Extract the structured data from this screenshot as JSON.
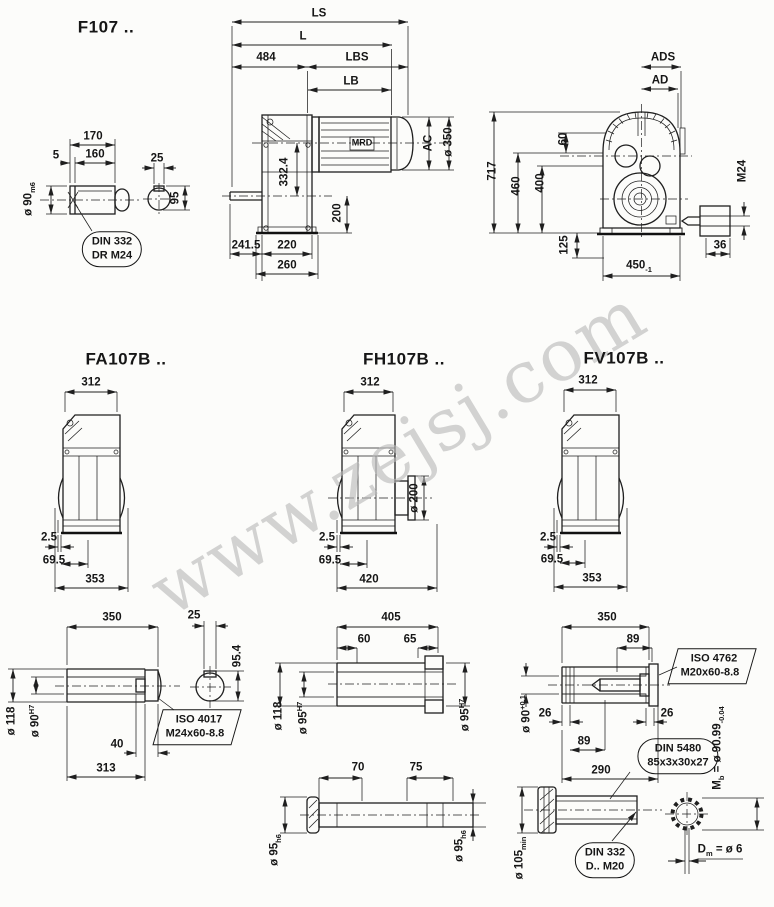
{
  "watermark": "www.zejsj.com",
  "f107": {
    "title": "F107 ..",
    "input_shaft": {
      "d170": "170",
      "d5": "5",
      "d160": "160",
      "dia90": "ø 90",
      "dia90_tol": "m6",
      "d25": "25",
      "d95": "95",
      "callout": {
        "line1": "DIN 332",
        "line2": "DR M24"
      }
    },
    "side": {
      "ls": "LS",
      "l": "L",
      "d484": "484",
      "lbs": "LBS",
      "lb": "LB",
      "motor": "MRD",
      "ac": "AC",
      "dia350": "ø 350",
      "d332": "332.4",
      "d200": "200",
      "d241": "241.5",
      "d220": "220",
      "d260": "260"
    },
    "front": {
      "ads": "ADS",
      "ad": "AD",
      "d717": "717",
      "d460": "460",
      "d400": "400",
      "d60": "60",
      "d125": "125",
      "d450": "450",
      "d450_tol": "-1",
      "m24": "M24",
      "d36": "36"
    }
  },
  "fa": {
    "title": "FA107B ..",
    "d312": "312",
    "d2_5": "2.5",
    "d69_5": "69.5",
    "d353": "353",
    "shaft": {
      "d350": "350",
      "d25": "25",
      "d95_4": "95.4",
      "dia118": "ø 118",
      "dia90": "ø 90",
      "dia90_tol": "H7",
      "d40": "40",
      "d313": "313",
      "callout": {
        "line1": "ISO 4017",
        "line2": "M24x60-8.8"
      }
    }
  },
  "fh": {
    "title": "FH107B ..",
    "d312": "312",
    "dia200": "ø 200",
    "d2_5": "2.5",
    "d69_5": "69.5",
    "d420": "420",
    "shaft": {
      "d405": "405",
      "d60": "60",
      "d65": "65",
      "dia118": "ø 118",
      "dia95_l": "ø 95",
      "dia95_l_tol": "H7",
      "dia95_r": "ø 95",
      "dia95_r_tol": "H7",
      "d70": "70",
      "d75": "75",
      "dia95_bl": "ø 95",
      "dia95_bl_tol": "h6",
      "dia95_br": "ø 95",
      "dia95_br_tol": "h6"
    }
  },
  "fv": {
    "title": "FV107B ..",
    "d312": "312",
    "d2_5": "2.5",
    "d69_5": "69.5",
    "d353": "353",
    "shaft": {
      "d350": "350",
      "d89_top": "89",
      "dia90": "ø 90",
      "dia90_tol": "+0.1",
      "d26_l": "26",
      "d26_r": "26",
      "d89_mid": "89",
      "d290": "290",
      "callout_iso": {
        "line1": "ISO 4762",
        "line2": "M20x60-8.8"
      },
      "callout_din5480": {
        "line1": "DIN 5480",
        "line2": "85x3x30x27"
      },
      "callout_din332": {
        "line1": "DIN 332",
        "line2": "D.. M20"
      },
      "dia105": "ø 105",
      "dia105_tol": "min",
      "mb_prefix": "M",
      "mb_sub": "b",
      "mb_val": " = ø 90.99",
      "mb_tol": "-0.04",
      "dm_prefix": "D",
      "dm_sub": "m",
      "dm_val": " = ø 6"
    }
  }
}
